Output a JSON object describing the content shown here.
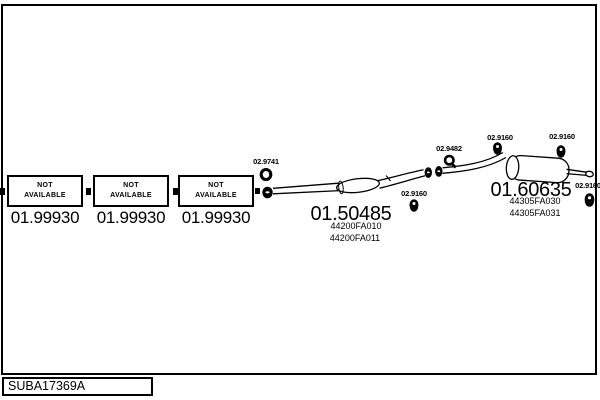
{
  "colors": {
    "ink": "#000000",
    "paper": "#ffffff"
  },
  "footer": {
    "diagram_code": "SUBA17369A"
  },
  "front_boxes": [
    {
      "status_line1": "NOT",
      "status_line2": "AVAILABLE",
      "part_number": "01.99930"
    },
    {
      "status_line1": "NOT",
      "status_line2": "AVAILABLE",
      "part_number": "01.99930"
    },
    {
      "status_line1": "NOT",
      "status_line2": "AVAILABLE",
      "part_number": "01.99930"
    }
  ],
  "labels": {
    "gasket": "02.9741",
    "mid_hanger": "02.9160",
    "clamp": "02.9482",
    "inlet_hanger": "02.9160",
    "top_hanger": "02.9160",
    "right_hanger": "02.9160"
  },
  "mid_assembly": {
    "part_number": "01.50485",
    "oem_refs": [
      "44200FA010",
      "44200FA011"
    ]
  },
  "rear_assembly": {
    "part_number": "01.60635",
    "oem_refs": [
      "44305FA030",
      "44305FA031"
    ]
  },
  "icons": {
    "gasket_icon": "ring-gasket",
    "clamp_icon": "clamp-with-bolt",
    "hanger_icon": "rubber-hanger",
    "flange_icon": "pipe-flange"
  }
}
